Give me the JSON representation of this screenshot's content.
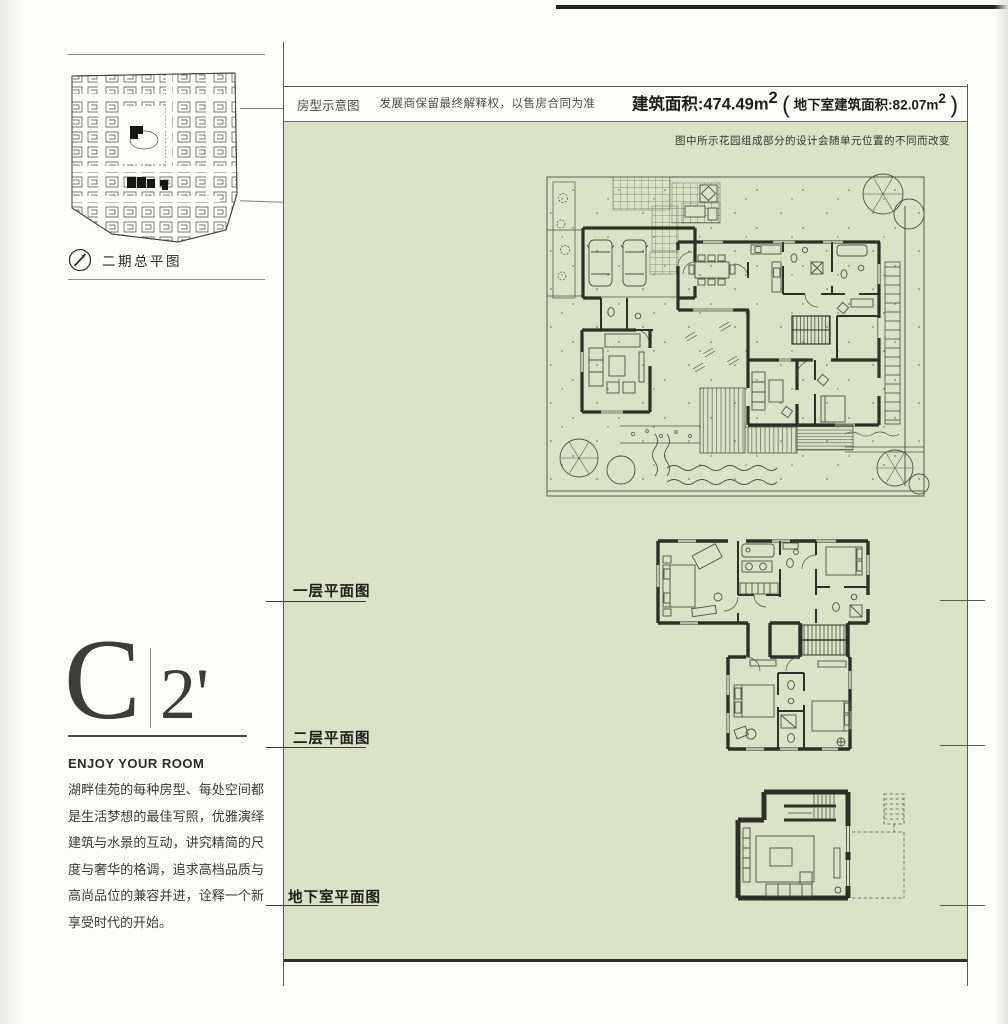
{
  "sidebar": {
    "site_map_caption": "二期总平图",
    "unit_code": "C",
    "unit_variant": "2'",
    "tagline": "ENJOY YOUR ROOM",
    "description": "湖畔佳苑的每种房型、每处空间都是生活梦想的最佳写照，优雅演绎建筑与水景的互动，讲究精简的尺度与奢华的格调，追求高档品质与高尚品位的兼容并进，诠释一个新享受时代的开始。"
  },
  "header": {
    "plan_type_label": "房型示意图",
    "disclaimer": "发展商保留最终解释权，以售房合同为准",
    "area_prefix": "建筑面积:474.49m",
    "area_sup": "2",
    "paren_open": "(",
    "basement_area_prefix": " 地下室建筑面积:82.07m",
    "basement_area_sup": "2",
    "paren_close": ")",
    "garden_note": "图中所示花园组成部分的设计会随单元位置的不同而改变"
  },
  "floor_labels": {
    "first": "一层平面图",
    "second": "二层平面图",
    "basement": "地下室平面图"
  },
  "colors": {
    "panel_green": "#dce2c6",
    "wall_ink": "#2f2f2a",
    "drawing_line": "#4b5042"
  }
}
